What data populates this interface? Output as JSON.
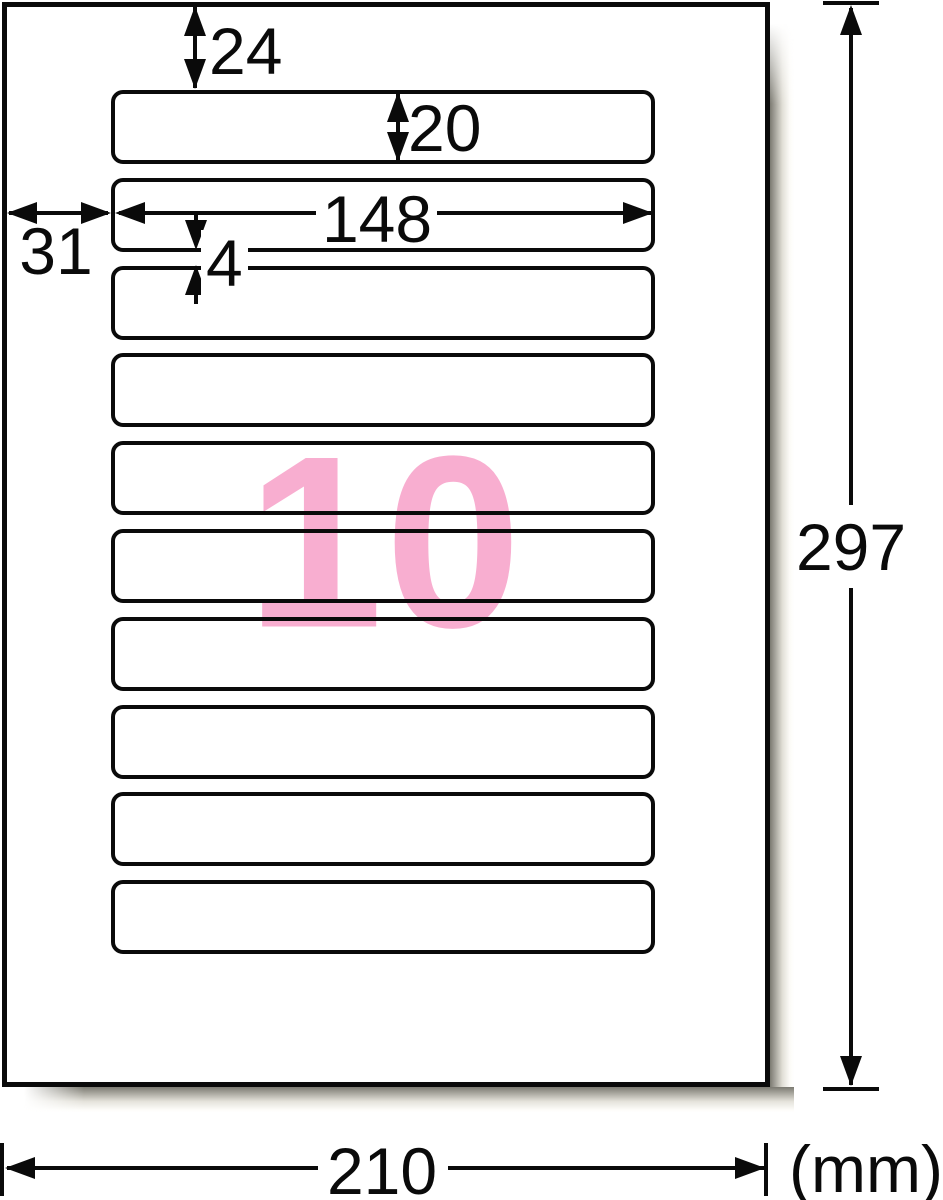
{
  "diagram": {
    "type": "label-sheet-dimension-diagram",
    "rows": 10,
    "labels_per_sheet": "10",
    "accent_pink": "#f8aed0",
    "line_color": "#0a0a0a",
    "unit_label": "(mm)",
    "dimensions": {
      "top_margin_mm": "24",
      "label_height_mm": "20",
      "label_width_mm": "148",
      "left_margin_mm": "31",
      "row_gap_mm": "4",
      "sheet_height_mm": "297",
      "sheet_width_mm": "210"
    }
  }
}
